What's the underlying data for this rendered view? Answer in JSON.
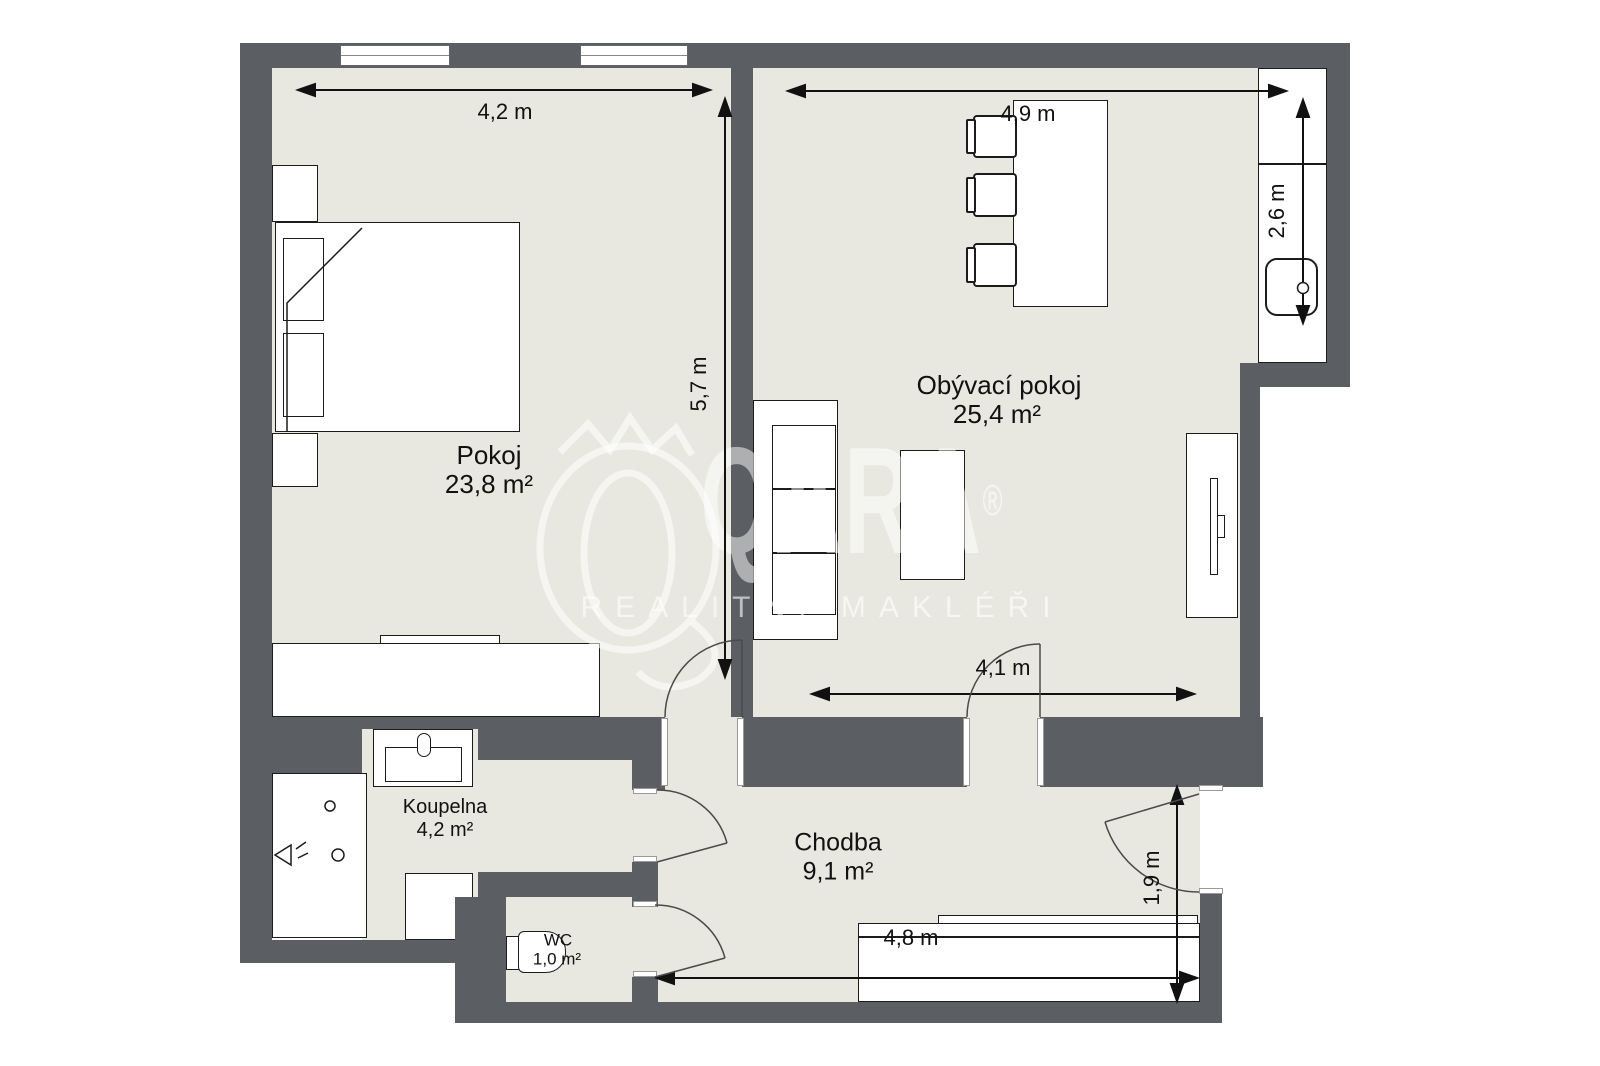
{
  "plan": {
    "rooms": [
      {
        "id": "pokoj",
        "name": "Pokoj",
        "area": "23,8 m²"
      },
      {
        "id": "obyvaci-pokoj",
        "name": "Obývací pokoj",
        "area": "25,4 m²"
      },
      {
        "id": "koupelna",
        "name": "Koupelna",
        "area": "4,2 m²"
      },
      {
        "id": "chodba",
        "name": "Chodba",
        "area": "9,1 m²"
      },
      {
        "id": "wc",
        "name": "WC",
        "area": "1,0 m²"
      }
    ],
    "dimensions": {
      "pokoj_width": "4,2 m",
      "pokoj_height": "5,7 m",
      "obyvaci_width": "4,9 m",
      "kitchen_depth": "2,6 m",
      "obyvaci_bottom_width": "4,1 m",
      "chodba_width": "4,8 m",
      "entry_depth": "1,9 m"
    },
    "watermark": {
      "brand": "QARA",
      "registered": "®",
      "tagline": "REALITNÍ MAKLÉŘI"
    },
    "colors": {
      "wall": "#5b5f63",
      "floor": "#e9e8e0"
    }
  }
}
